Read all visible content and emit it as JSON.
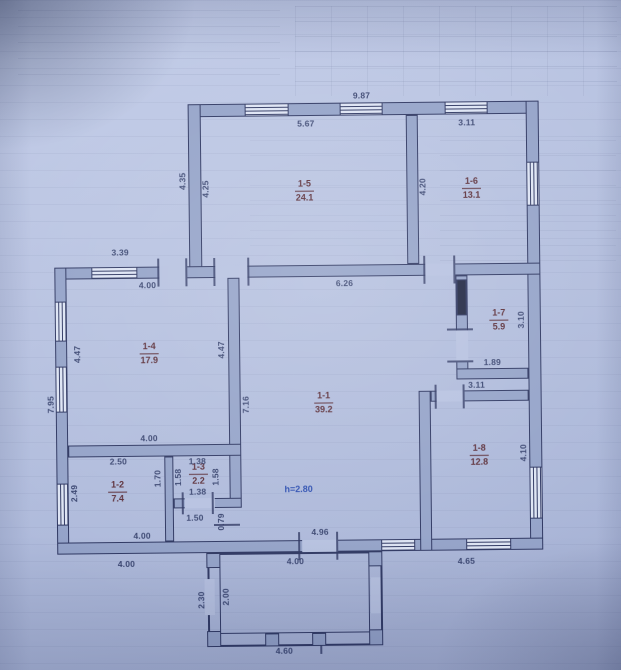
{
  "rooms": [
    {
      "number": "1-5",
      "area": "24.1"
    },
    {
      "number": "1-6",
      "area": "13.1"
    },
    {
      "number": "1-4",
      "area": "17.9"
    },
    {
      "number": "1-1",
      "area": "39.2"
    },
    {
      "number": "1-7",
      "area": "5.9"
    },
    {
      "number": "1-8",
      "area": "12.8"
    },
    {
      "number": "1-2",
      "area": "7.4"
    },
    {
      "number": "1-3",
      "area": "2.2"
    }
  ],
  "height_note": "h=2.80",
  "dims": [
    "9.87",
    "5.67",
    "3.11",
    "4.35",
    "4.25",
    "4.20",
    "3.39",
    "4.00",
    "6.26",
    "4.47",
    "4.47",
    "7.95",
    "7.16",
    "3.10",
    "1.89",
    "3.11",
    "4.10",
    "4.00",
    "2.50",
    "1.38",
    "1.70",
    "1.58",
    "1.58",
    "2.49",
    "1.38",
    "1.50",
    "0.79",
    "4.00",
    "4.96",
    "4.00",
    "4.00",
    "4.65",
    "2.30",
    "2.00",
    "4.60"
  ],
  "colors": {
    "paper": "#b6c1e0",
    "wall_fill": "#93a2c8",
    "line": "#2c3560",
    "room_label": "#55242e",
    "dim_text": "#2e3a66",
    "height_note": "#2b4db0"
  }
}
